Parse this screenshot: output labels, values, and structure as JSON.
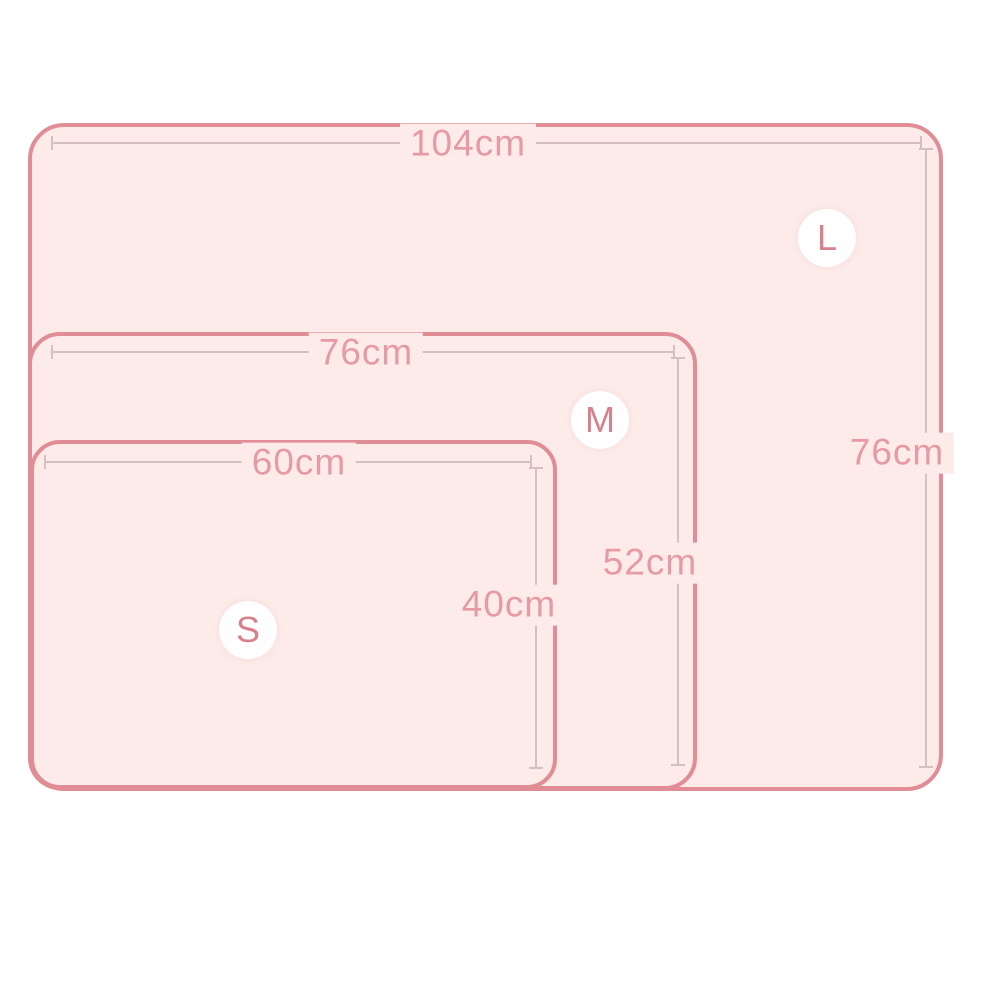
{
  "diagram": {
    "type": "nested-product-size-diagram",
    "unit": "cm",
    "background_color": "#ffffff",
    "mat_fill_color": "#fcebe9",
    "mat_border_color": "#e18d96",
    "dimension_line_color": "#d5bfc1",
    "label_color": "#e69aa3",
    "badge_background_color": "#ffffff",
    "badge_text_color": "#d8818e",
    "sizes": [
      {
        "label": "L",
        "width": "104cm",
        "height": "76cm"
      },
      {
        "label": "M",
        "width": "76cm",
        "height": "52cm"
      },
      {
        "label": "S",
        "width": "60cm",
        "height": "40cm"
      }
    ]
  }
}
